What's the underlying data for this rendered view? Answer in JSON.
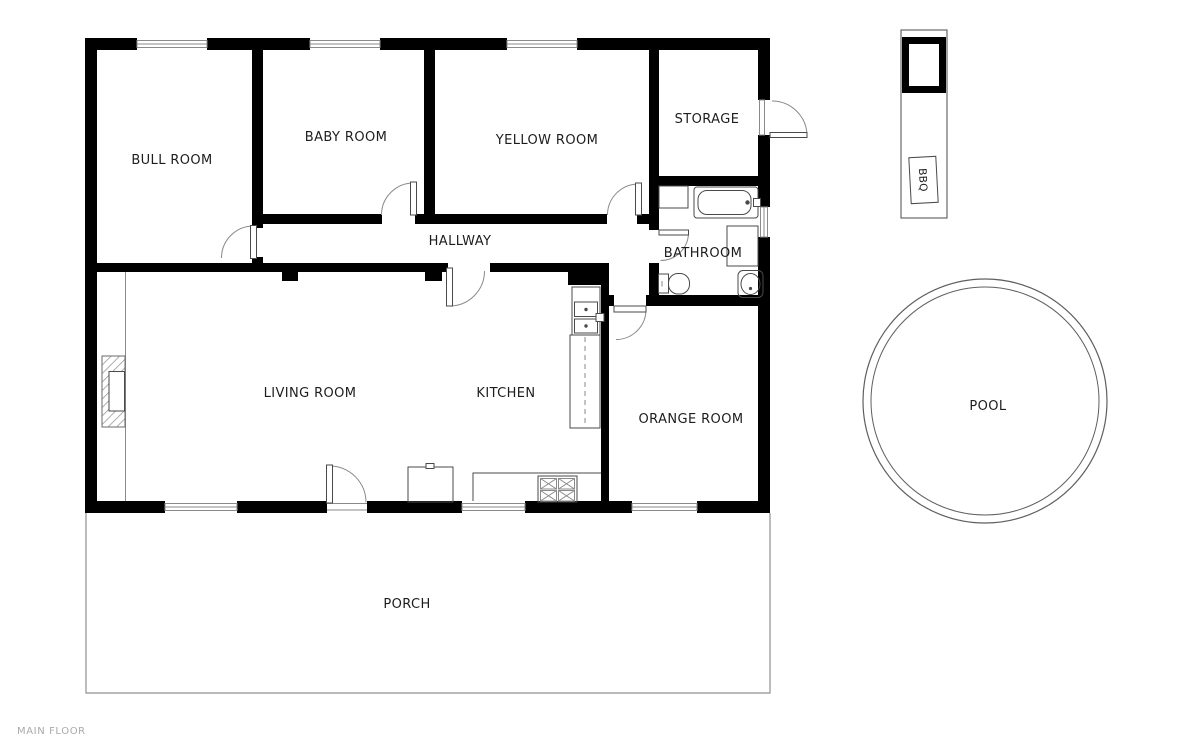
{
  "floor_label": "MAIN FLOOR",
  "rooms": {
    "bull": {
      "label": "BULL ROOM"
    },
    "baby": {
      "label": "BABY ROOM"
    },
    "yellow": {
      "label": "YELLOW ROOM"
    },
    "storage": {
      "label": "STORAGE"
    },
    "hallway": {
      "label": "HALLWAY"
    },
    "bathroom": {
      "label": "BATHROOM"
    },
    "living": {
      "label": "LIVING ROOM"
    },
    "kitchen": {
      "label": "KITCHEN"
    },
    "orange": {
      "label": "ORANGE ROOM"
    },
    "porch": {
      "label": "PORCH"
    }
  },
  "outdoor": {
    "pool": {
      "label": "POOL"
    },
    "bbq": {
      "label": "BBQ"
    }
  },
  "colors": {
    "wall": "#000000",
    "line": "#4a4a4a",
    "light": "#8a8a8a",
    "label": "#1d1d1d",
    "muted": "#a9a9a9",
    "bg": "#ffffff"
  }
}
